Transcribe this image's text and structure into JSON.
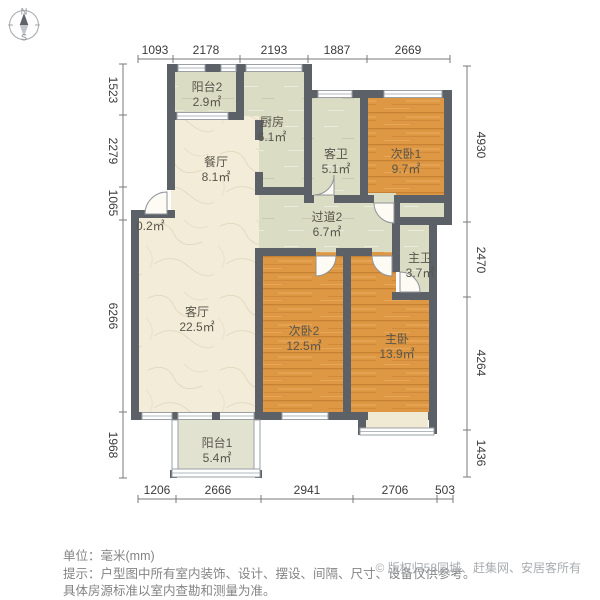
{
  "compass": {
    "north": "N",
    "south": "S"
  },
  "dimensions": {
    "top": [
      "1093",
      "2178",
      "2193",
      "1887",
      "2669"
    ],
    "left": [
      "1523",
      "2279",
      "1065",
      "6266",
      "1968"
    ],
    "right": [
      "4930",
      "2470",
      "4264",
      "1436"
    ],
    "bottom": [
      "1206",
      "2666",
      "2941",
      "2706",
      "503"
    ]
  },
  "rooms": {
    "yangtai2": {
      "name": "阳台2",
      "area": "2.9㎡"
    },
    "chufang": {
      "name": "厨房",
      "area": "6.1㎡"
    },
    "canting": {
      "name": "餐厅",
      "area": "8.1㎡"
    },
    "kewei": {
      "name": "客卫",
      "area": "5.1㎡"
    },
    "ciwo1": {
      "name": "次卧1",
      "area": "9.7㎡"
    },
    "guodao2": {
      "name": "过道2",
      "area": "6.7㎡"
    },
    "zhuwei": {
      "name": "主卫",
      "area": "3.7㎡"
    },
    "keting": {
      "name": "客厅",
      "area": "22.5㎡"
    },
    "ciwo2": {
      "name": "次卧2",
      "area": "12.5㎡"
    },
    "zhuwo": {
      "name": "主卧",
      "area": "13.9㎡"
    },
    "yangtai1": {
      "name": "阳台1",
      "area": "5.4㎡"
    },
    "entry_niche": {
      "area": "0.2㎡"
    }
  },
  "footer": {
    "unit": "单位：毫米(mm)",
    "tip1": "提示：户型图中所有室内装饰、设计、摆设、间隔、尺寸、设备仅供参考。",
    "tip2": "具体房源标准以室内查勘和测量为准。",
    "copyright": "© 版权归58同城、赶集网、安居客所有"
  },
  "colors": {
    "wall": "#5c6167",
    "bedroom_floor": "#de9742",
    "living_floor": "#f3ecd9",
    "service_floor": "#dadcc4",
    "balcony_floor": "#e1e3d0"
  }
}
